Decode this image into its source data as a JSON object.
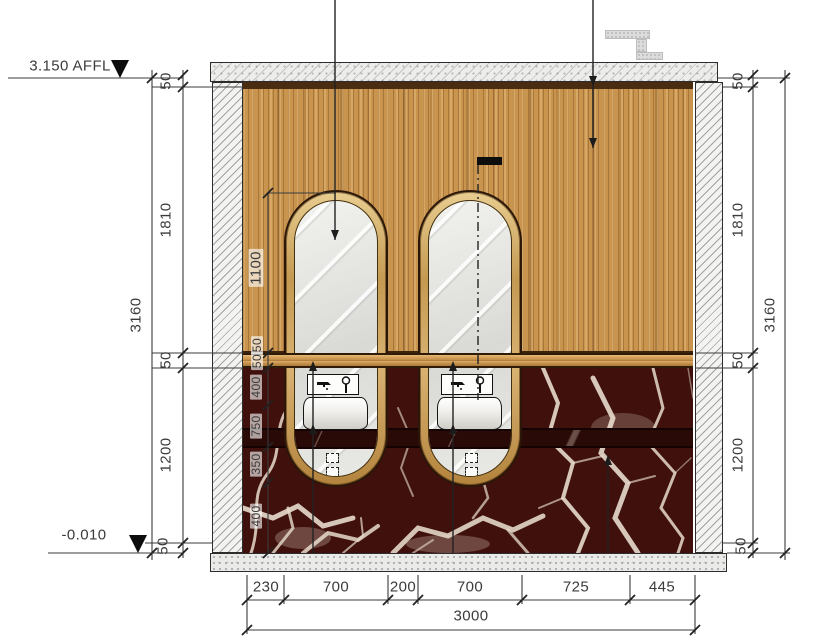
{
  "levels": {
    "top": "3.150 AFFL",
    "bottom": "-0.010"
  },
  "dimensions": {
    "left": {
      "segments": [
        "50",
        "1810",
        "50",
        "1200",
        "50"
      ],
      "total": "3160"
    },
    "right": {
      "segments": [
        "50",
        "1810",
        "50",
        "1200",
        "50"
      ],
      "total": "3160"
    },
    "bottom": {
      "segments": [
        "230",
        "700",
        "200",
        "700",
        "725",
        "445"
      ],
      "total": "3000"
    },
    "inner": {
      "mirror_height": "1100",
      "shelf": "50",
      "segments": [
        "50",
        "400",
        "750",
        "350",
        "400"
      ]
    }
  },
  "colors": {
    "wood": "#c8944e",
    "wood-dark": "#4a2c10",
    "marble": "#3f100c",
    "vein": "#e8dccd",
    "counter": "#2a0a07",
    "gold": "#c9a45f",
    "glass": "#e3e3df",
    "line": "#3b3b3b"
  }
}
